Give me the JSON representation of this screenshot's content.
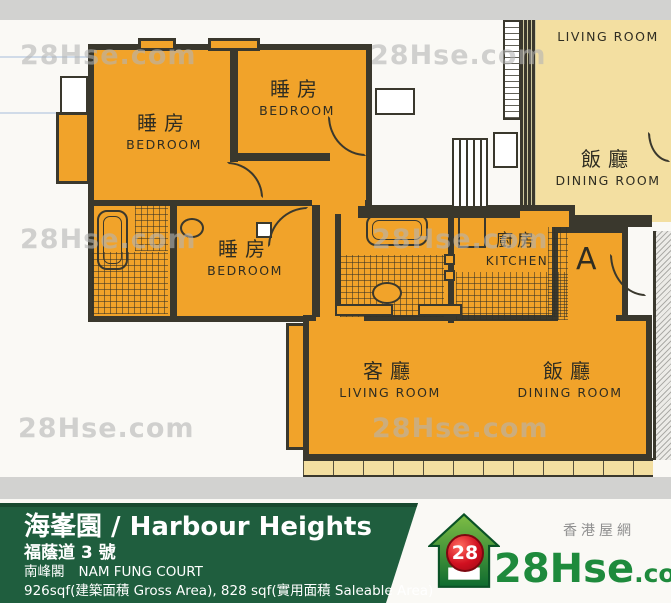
{
  "colors": {
    "orange": "#F1A32A",
    "cream": "#F3DFA1",
    "wall": "#3A382D",
    "green": "#1F5E3E",
    "green-dark": "#17492F",
    "logo-green": "#1E8A3C",
    "red": "#CC1122",
    "wm": "#B5B5B5"
  },
  "watermark": {
    "text": "28Hse.com"
  },
  "plan": {
    "unit_label": "A",
    "rooms": {
      "bedroom1": {
        "zh": "睡房",
        "en": "BEDROOM"
      },
      "bedroom2": {
        "zh": "睡房",
        "en": "BEDROOM"
      },
      "bedroom3": {
        "zh": "睡房",
        "en": "BEDROOM"
      },
      "kitchen": {
        "zh": "廚房",
        "en": "KITCHEN"
      },
      "living": {
        "zh": "客廳",
        "en": "LIVING ROOM"
      },
      "dining": {
        "zh": "飯廳",
        "en": "DINING ROOM"
      },
      "neighbor_living": {
        "en": "LIVING ROOM"
      },
      "neighbor_dining": {
        "zh": "飯廳",
        "en": "DINING ROOM"
      }
    }
  },
  "footer": {
    "title": "海峯園 / Harbour Heights",
    "address": "福蔭道 3 號",
    "block_zh": "南峰閣",
    "block_en": "NAM FUNG COURT",
    "area_info": "926sqf(建築面積 Gross Area), 828 sqf(實用面積 Saleable Area)"
  },
  "logo": {
    "tagline": "香港屋網",
    "brand": "28Hse",
    "suffix": ".com",
    "badge": "28"
  }
}
